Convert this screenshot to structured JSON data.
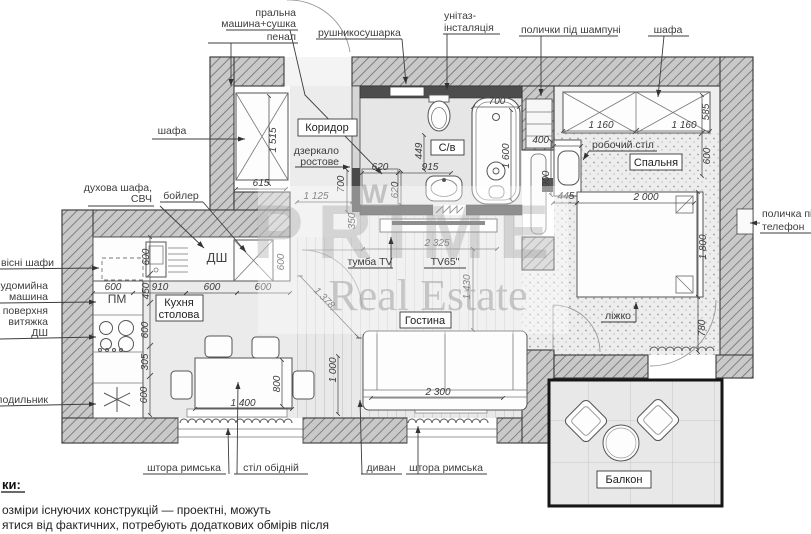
{
  "watermark": {
    "word": "PRIME",
    "sub": "Real Estate",
    "frag": "W"
  },
  "rooms": {
    "corridor": "Коридор",
    "bathroom": "С/в",
    "kitchen_line1": "Кухня",
    "kitchen_line2": "столова",
    "living": "Гостина",
    "bedroom": "Спальня",
    "balcony": "Балкон"
  },
  "marks": {
    "pm": "ПМ",
    "dsh": "ДШ"
  },
  "callouts": {
    "washer_line1": "пральна",
    "washer_line2": "машина+сушка",
    "penal": "пенал",
    "towel_dryer": "рушникосушарка",
    "toilet_line1": "унітаз-",
    "toilet_line2": "інсталяція",
    "shampoo_shelves": "полички під шампуні",
    "wardrobe_top": "шафа",
    "wardrobe_left": "шафа",
    "oven_line1": "духова шафа,",
    "oven_line2": "СВЧ",
    "boiler": "бойлер",
    "wall_cabinets": "вісні шафи",
    "dishwasher_line1": "судомийна",
    "dishwasher_line2": "машина",
    "hob_line1": "а поверхня",
    "hob_line2": "витяжка",
    "hob_line3": "ДШ",
    "fridge": "олодильник",
    "phone_line1": "поличка під",
    "phone_line2": "телефон",
    "mirror_line1": "дзеркало",
    "mirror_line2": "ростове",
    "desk": "робочий стіл",
    "bed": "ліжко",
    "curtain_left": "штора римська",
    "dining_table": "стіл обідній",
    "sofa": "диван",
    "curtain_right": "штора римська",
    "tv_stand": "тумба TV",
    "tv": "TV65\""
  },
  "dims": {
    "closet_h": "1 515",
    "closet_w": "615",
    "mirror_h": "700",
    "corridor_w": "1 125",
    "mirror_gap": "350",
    "washer_w": "620",
    "washer_d": "620",
    "sink_gap": "915",
    "toilet_gap": "449",
    "tub_w": "700",
    "tub_len": "1 600",
    "desk_depth": "400",
    "desk_len": "900",
    "wardrobe_a": "1 160",
    "wardrobe_b": "1 160",
    "wardrobe_depth": "585",
    "walkway": "600",
    "bed_gap": "445",
    "bed_len": "2 000",
    "bed_width": "1 800",
    "bed_foot": "780",
    "kcol_a": "600",
    "kcol_b": "450",
    "kcol_c": "600",
    "kcol_d": "305",
    "kcol_e": "600",
    "krow_a": "600",
    "krow_b": "910",
    "krow_c": "600",
    "krow_d": "600",
    "counter_depth": "600",
    "table_len": "1 400",
    "table_w": "800",
    "sofa_gap": "1 000",
    "diag": "1 378",
    "tv_wall": "2 325",
    "living_len": "1 430",
    "sofa_len": "2 300"
  },
  "notes": {
    "heading": "ки:",
    "line1": "озміри існуючих конструкцій — проектні, можуть",
    "line2": "ятися від фактичних, потребують додаткових обмірів після"
  }
}
